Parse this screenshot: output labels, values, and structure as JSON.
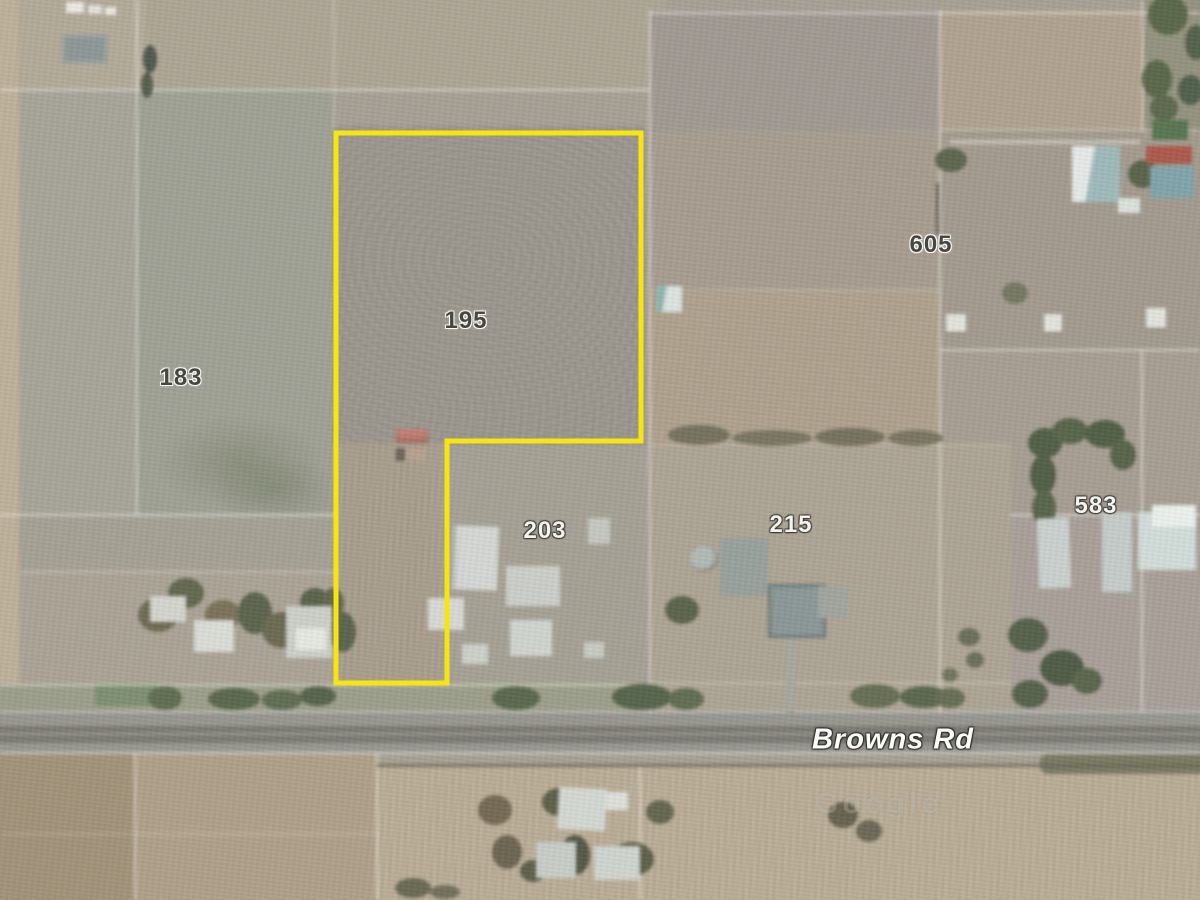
{
  "map": {
    "description": "Satellite aerial view of rural parcels with highlighted property boundary",
    "road": {
      "label": "Browns Rd"
    },
    "watermark": "Google",
    "boundary": {
      "color": "#F6E50F",
      "points": "336,133 641,133 641,441 447,441 447,683 336,683"
    },
    "parcels": [
      {
        "id": "183",
        "x": 181,
        "y": 378,
        "style": "dark"
      },
      {
        "id": "195",
        "x": 466,
        "y": 321,
        "style": "dark"
      },
      {
        "id": "605",
        "x": 931,
        "y": 245,
        "style": "dark"
      },
      {
        "id": "203",
        "x": 545,
        "y": 531,
        "style": "light"
      },
      {
        "id": "215",
        "x": 791,
        "y": 525,
        "style": "light"
      },
      {
        "id": "583",
        "x": 1096,
        "y": 506,
        "style": "light"
      }
    ]
  }
}
